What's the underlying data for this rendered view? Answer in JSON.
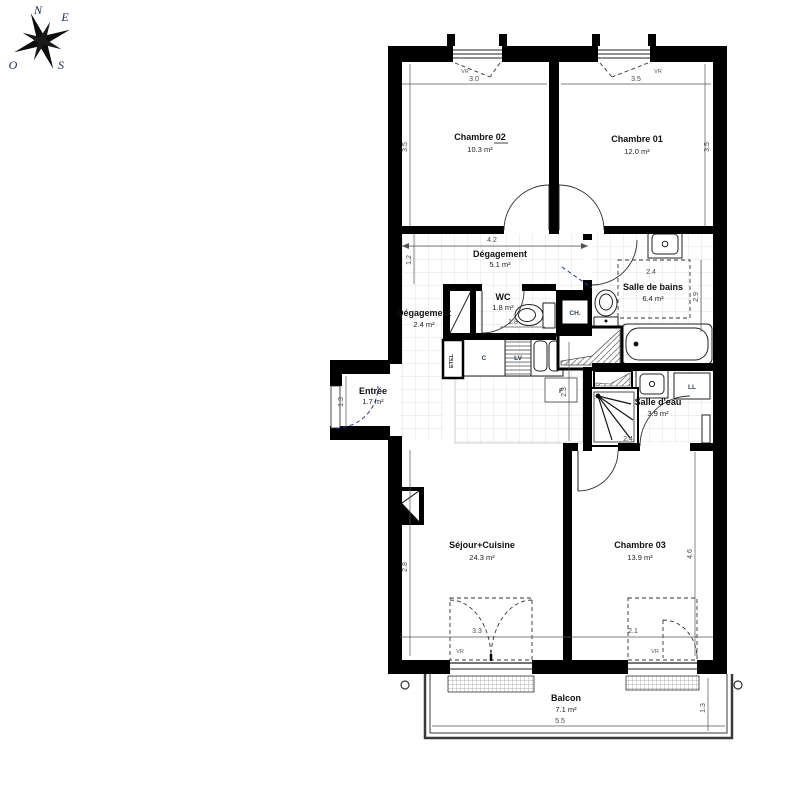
{
  "compass": {
    "n": "N",
    "e": "E",
    "s": "S",
    "o": "O"
  },
  "rooms": {
    "chambre02": {
      "name": "Chambre 02",
      "area": "10.3 m²"
    },
    "chambre01": {
      "name": "Chambre 01",
      "area": "12.0 m²"
    },
    "degagement1": {
      "name": "Dégagement",
      "area": "5.1 m²"
    },
    "salle_de_bains": {
      "name": "Salle de bains",
      "area": "6.4 m²"
    },
    "wc": {
      "name": "WC",
      "area": "1.8 m²"
    },
    "degagement2": {
      "name": "Dégagement",
      "area": "2.4 m²"
    },
    "entree": {
      "name": "Entrée",
      "area": "1.7 m²"
    },
    "salle_deau": {
      "name": "Salle d'eau",
      "area": "3.9 m²"
    },
    "sejour": {
      "name": "Séjour+Cuisine",
      "area": "24.3 m²"
    },
    "chambre03": {
      "name": "Chambre 03",
      "area": "13.9 m²"
    },
    "balcon": {
      "name": "Balcon",
      "area": "7.1 m²"
    }
  },
  "dims": {
    "chambre02_width": "3.0",
    "chambre01_width": "3.5",
    "chambre02_height": "3.5",
    "chambre01_height": "3.5",
    "degagement_width": "4.2",
    "degagement_height": "1.2",
    "sdb_width": "2.4",
    "sdb_height": "2.9",
    "wc_width": "1.8",
    "entree_height": "1.3",
    "kitchen_depth": "2.3",
    "salle_deau_width": "2.4",
    "sejour_height": "2.8",
    "chambre03_height": "4.6",
    "sejour_window": "3.3",
    "chambre03_window": "2.1",
    "balcon_width": "5.5",
    "balcon_height": "1.3"
  },
  "equipment": {
    "vr": "VR",
    "ch": "CH.",
    "etel": "ETEL",
    "c": "C",
    "lv": "LV",
    "f": "F",
    "ll": "LL"
  },
  "colors": {
    "wall": "#000000",
    "door_swing_blue": "#2a35b8",
    "dim_text": "#474747",
    "hatch": "#8a8a8a",
    "tile": "#cccccc"
  }
}
